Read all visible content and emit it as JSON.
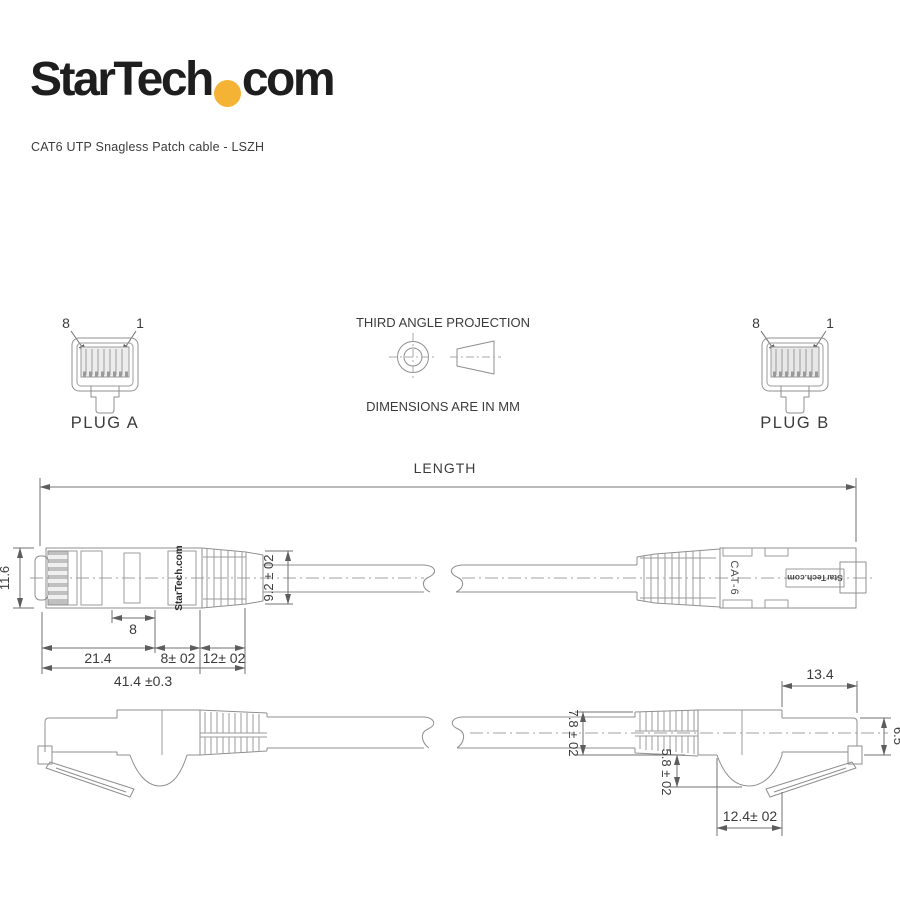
{
  "brand": {
    "name_main": "StarTech",
    "name_suffix": "com",
    "dot_color": "#F5B335",
    "subtitle": "CAT6 UTP Snagless Patch cable - LSZH"
  },
  "projection": {
    "title": "THIRD ANGLE PROJECTION",
    "units": "DIMENSIONS ARE IN MM"
  },
  "plug_a": {
    "label": "PLUG A",
    "pin_left": "8",
    "pin_right": "1"
  },
  "plug_b": {
    "label": "PLUG B",
    "pin_left": "8",
    "pin_right": "1"
  },
  "length_dim": {
    "label": "LENGTH"
  },
  "top_view": {
    "connector_height": "11.6",
    "latch_window_width": "8",
    "body_length": "21.4",
    "boot_section_1": "8± 02",
    "boot_section_2": "12± 02",
    "overall_length": "41.4 ±0.3",
    "boot_diameter": "9.2 ± 02",
    "brand_marking": "StarTech.com",
    "cat_marking": "CAT-6",
    "brand_marking_mirrored": "StarTech.com"
  },
  "side_view": {
    "boot_diameter": "7.8 ± 02",
    "latch_depth": "5.8 ± 02",
    "hook_width": "12.4± 02",
    "nose_length": "13.4",
    "nose_height": "6.5"
  },
  "colors": {
    "line": "#8F8F8F",
    "dimension": "#707070",
    "text": "#3B3B3B",
    "accent": "#F5B335"
  }
}
